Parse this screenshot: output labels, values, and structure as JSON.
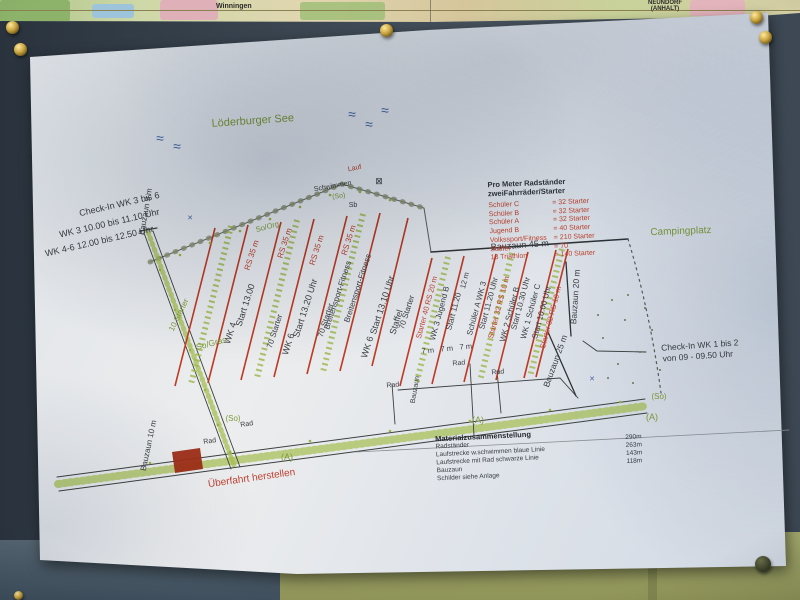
{
  "map_strip": {
    "town_left": "Winningen",
    "town_right_line1": "NEUNDORF",
    "town_right_line2": "(ANHALT)"
  },
  "plan": {
    "legend": {
      "title_line1": "Pro Meter Radständer",
      "title_line2": "zweiFahrräder/Starter",
      "rows": [
        {
          "label": "Schüler  C",
          "value": "=  32 Starter"
        },
        {
          "label": "Schüler  B",
          "value": "=  32 Starter"
        },
        {
          "label": "Schüler  A",
          "value": "=  32 Starter"
        },
        {
          "label": "Jugend  B",
          "value": "=  40 Starter"
        },
        {
          "label": "Volkssport/Fitness",
          "value": "=  210 Starter"
        },
        {
          "label": "Staffel",
          "value": "=  70"
        },
        {
          "label": "13 Triathlon",
          "value": "= 140 Starter"
        }
      ]
    },
    "materials": {
      "title": "Materialzusammenstellung",
      "rows": [
        {
          "label": "Radständer",
          "value": "290m"
        },
        {
          "label": "Laufstrecke w.schwimmen blaue Linie",
          "value": "263m"
        },
        {
          "label": "Laufstrecke mit Rad schwarze Linie",
          "value": "143m"
        },
        {
          "label": "Bauzaun",
          "value": "118m"
        },
        {
          "label": "Schilder siehe Anlage",
          "value": ""
        }
      ]
    },
    "annotations": [
      {
        "t": "≈",
        "x": 160,
        "y": 143,
        "r": 0,
        "c": "blue",
        "s": 14
      },
      {
        "t": "≈",
        "x": 177,
        "y": 151,
        "r": 0,
        "c": "blue",
        "s": 14
      },
      {
        "t": "≈",
        "x": 352,
        "y": 119,
        "r": 0,
        "c": "blue",
        "s": 14
      },
      {
        "t": "≈",
        "x": 369,
        "y": 129,
        "r": 0,
        "c": "blue",
        "s": 14
      },
      {
        "t": "≈",
        "x": 385,
        "y": 115,
        "r": 0,
        "c": "blue",
        "s": 14
      },
      {
        "t": "Löderburger See",
        "x": 253,
        "y": 124,
        "r": -4,
        "c": "green",
        "s": 11
      },
      {
        "t": "Campingplatz",
        "x": 681,
        "y": 234,
        "r": -2,
        "c": "green",
        "s": 10
      },
      {
        "t": "Check-In  WK  3 bis 6",
        "x": 120,
        "y": 207,
        "r": -13,
        "c": "ink",
        "s": 9
      },
      {
        "t": "WK 3    10.00 bis 11.10 Uhr",
        "x": 110,
        "y": 226,
        "r": -13,
        "c": "ink",
        "s": 9
      },
      {
        "t": "WK 4-6    12.00 bis 12.50 Uhr",
        "x": 100,
        "y": 244,
        "r": -13,
        "c": "ink",
        "s": 9
      },
      {
        "t": "Check-In  WK  1 bis 2",
        "x": 700,
        "y": 348,
        "r": -4,
        "c": "ink",
        "s": 8.5
      },
      {
        "t": "von 09  -  09.50 Uhr",
        "x": 698,
        "y": 359,
        "r": -4,
        "c": "ink",
        "s": 8.5
      },
      {
        "t": "Bauzaun 9 m",
        "x": 148,
        "y": 212,
        "r": -80,
        "c": "ink",
        "s": 8
      },
      {
        "t": "Bauzaun 10 m",
        "x": 151,
        "y": 446,
        "r": -78,
        "c": "ink",
        "s": 8
      },
      {
        "t": "Bauzaun  45 m",
        "x": 520,
        "y": 248,
        "r": -4,
        "c": "ink",
        "s": 9
      },
      {
        "t": "Bauzaun  20 m",
        "x": 578,
        "y": 297,
        "r": -86,
        "c": "ink",
        "s": 8.5
      },
      {
        "t": "Bauzaun 25 m",
        "x": 558,
        "y": 362,
        "r": -70,
        "c": "ink",
        "s": 8.5
      },
      {
        "t": "Bauzaun",
        "x": 417,
        "y": 390,
        "r": -80,
        "c": "ink",
        "s": 7
      },
      {
        "t": "10 Starter",
        "x": 181,
        "y": 316,
        "r": -64,
        "c": "green",
        "s": 8
      },
      {
        "t": "So/Gras",
        "x": 212,
        "y": 346,
        "r": -15,
        "c": "green",
        "s": 8.5
      },
      {
        "t": "So/Org",
        "x": 268,
        "y": 229,
        "r": -15,
        "c": "green",
        "s": 7.5
      },
      {
        "t": "(So)",
        "x": 233,
        "y": 421,
        "r": 0,
        "c": "green",
        "s": 8
      },
      {
        "t": "(So)",
        "x": 659,
        "y": 399,
        "r": 0,
        "c": "green",
        "s": 8
      },
      {
        "t": "(So)",
        "x": 339,
        "y": 198,
        "r": -8,
        "c": "green",
        "s": 7
      },
      {
        "t": "(A)",
        "x": 478,
        "y": 423,
        "r": 0,
        "c": "green",
        "s": 9
      },
      {
        "t": "(A)",
        "x": 652,
        "y": 420,
        "r": 0,
        "c": "green",
        "s": 9
      },
      {
        "t": "(A)",
        "x": 287,
        "y": 460,
        "r": 0,
        "c": "green",
        "s": 9
      },
      {
        "t": "Lauf",
        "x": 355,
        "y": 170,
        "r": -12,
        "c": "red",
        "s": 7
      },
      {
        "t": "Schwimmen",
        "x": 333,
        "y": 188,
        "r": -10,
        "c": "ink",
        "s": 7
      },
      {
        "t": "Sb",
        "x": 353,
        "y": 207,
        "r": 0,
        "c": "ink",
        "s": 7
      },
      {
        "t": "⊠",
        "x": 379,
        "y": 184,
        "r": 0,
        "c": "ink",
        "s": 9
      },
      {
        "t": "✕",
        "x": 190,
        "y": 220,
        "r": 0,
        "c": "blue",
        "s": 7
      },
      {
        "t": "✕",
        "x": 592,
        "y": 381,
        "r": 0,
        "c": "blue",
        "s": 7
      },
      {
        "t": "RS 35 m",
        "x": 254,
        "y": 256,
        "r": -72,
        "c": "red",
        "s": 8
      },
      {
        "t": "RS 35 m",
        "x": 287,
        "y": 244,
        "r": -72,
        "c": "red",
        "s": 8
      },
      {
        "t": "RS 35 m",
        "x": 319,
        "y": 251,
        "r": -72,
        "c": "red",
        "s": 8
      },
      {
        "t": "RS 35 m",
        "x": 351,
        "y": 241,
        "r": -72,
        "c": "red",
        "s": 8
      },
      {
        "t": "WK 4",
        "x": 233,
        "y": 334,
        "r": -72,
        "c": "ink",
        "s": 9
      },
      {
        "t": "Start 13.00",
        "x": 248,
        "y": 306,
        "r": -72,
        "c": "ink",
        "s": 9
      },
      {
        "t": "70 Starter",
        "x": 277,
        "y": 332,
        "r": -72,
        "c": "ink",
        "s": 8
      },
      {
        "t": "WK 6",
        "x": 291,
        "y": 345,
        "r": -72,
        "c": "ink",
        "s": 9
      },
      {
        "t": "Start 13.20 Uhr",
        "x": 308,
        "y": 309,
        "r": -72,
        "c": "ink",
        "s": 9
      },
      {
        "t": "70 Starter",
        "x": 328,
        "y": 321,
        "r": -72,
        "c": "ink",
        "s": 8
      },
      {
        "t": "Breitensport-Fitness",
        "x": 340,
        "y": 296,
        "r": -72,
        "c": "ink",
        "s": 8
      },
      {
        "t": "Breitensport-Fitness",
        "x": 360,
        "y": 289,
        "r": -72,
        "c": "ink",
        "s": 8
      },
      {
        "t": "WK 6",
        "x": 370,
        "y": 348,
        "r": -72,
        "c": "ink",
        "s": 9
      },
      {
        "t": "Start 13.10 Uhr",
        "x": 385,
        "y": 306,
        "r": -72,
        "c": "ink",
        "s": 9
      },
      {
        "t": "Staffel",
        "x": 399,
        "y": 323,
        "r": -72,
        "c": "ink",
        "s": 9
      },
      {
        "t": "70 Starter",
        "x": 409,
        "y": 313,
        "r": -72,
        "c": "ink",
        "s": 8
      },
      {
        "t": "Starter 40  RS 20 m",
        "x": 429,
        "y": 308,
        "r": -75,
        "c": "red",
        "s": 7.5
      },
      {
        "t": "WK 3 Jugend B",
        "x": 442,
        "y": 314,
        "r": -75,
        "c": "ink",
        "s": 8
      },
      {
        "t": "Start 11.20",
        "x": 456,
        "y": 312,
        "r": -75,
        "c": "ink",
        "s": 8
      },
      {
        "t": "12 m",
        "x": 467,
        "y": 281,
        "r": -75,
        "c": "ink",
        "s": 7.5
      },
      {
        "t": "Schüler A  WK 3",
        "x": 479,
        "y": 309,
        "r": -75,
        "c": "ink",
        "s": 8
      },
      {
        "t": "Start 11.20 Uhr",
        "x": 491,
        "y": 304,
        "r": -75,
        "c": "ink",
        "s": 8
      },
      {
        "t": "Starter 32  RS 10 m",
        "x": 501,
        "y": 308,
        "r": -75,
        "c": "red",
        "s": 7.5
      },
      {
        "t": "WK 2 Schüler B",
        "x": 512,
        "y": 315,
        "r": -75,
        "c": "ink",
        "s": 8
      },
      {
        "t": "Start 10.30 Uhr",
        "x": 523,
        "y": 304,
        "r": -75,
        "c": "ink",
        "s": 8
      },
      {
        "t": "WK 1 Schüler C",
        "x": 533,
        "y": 312,
        "r": -75,
        "c": "ink",
        "s": 8
      },
      {
        "t": "Start 10.00 Uhr",
        "x": 544,
        "y": 313,
        "r": -75,
        "c": "ink",
        "s": 8
      },
      {
        "t": "Starter 32  RS 10 m",
        "x": 553,
        "y": 318,
        "r": -75,
        "c": "red",
        "s": 7.5
      },
      {
        "t": "7 m",
        "x": 428,
        "y": 353,
        "r": -5,
        "c": "ink",
        "s": 7.5
      },
      {
        "t": "7 m",
        "x": 447,
        "y": 351,
        "r": -5,
        "c": "ink",
        "s": 7.5
      },
      {
        "t": "7 m",
        "x": 466,
        "y": 349,
        "r": -5,
        "c": "ink",
        "s": 7.5
      },
      {
        "t": "Rad",
        "x": 393,
        "y": 387,
        "r": -5,
        "c": "ink",
        "s": 7
      },
      {
        "t": "Rad",
        "x": 459,
        "y": 365,
        "r": -5,
        "c": "ink",
        "s": 7
      },
      {
        "t": "Rad",
        "x": 498,
        "y": 374,
        "r": -5,
        "c": "ink",
        "s": 7
      },
      {
        "t": "Rad",
        "x": 247,
        "y": 426,
        "r": -8,
        "c": "ink",
        "s": 7
      },
      {
        "t": "Rad",
        "x": 210,
        "y": 443,
        "r": -8,
        "c": "ink",
        "s": 7
      },
      {
        "t": "Überfahrt  herstellen",
        "x": 252,
        "y": 481,
        "r": -8,
        "c": "red",
        "s": 10
      }
    ]
  }
}
